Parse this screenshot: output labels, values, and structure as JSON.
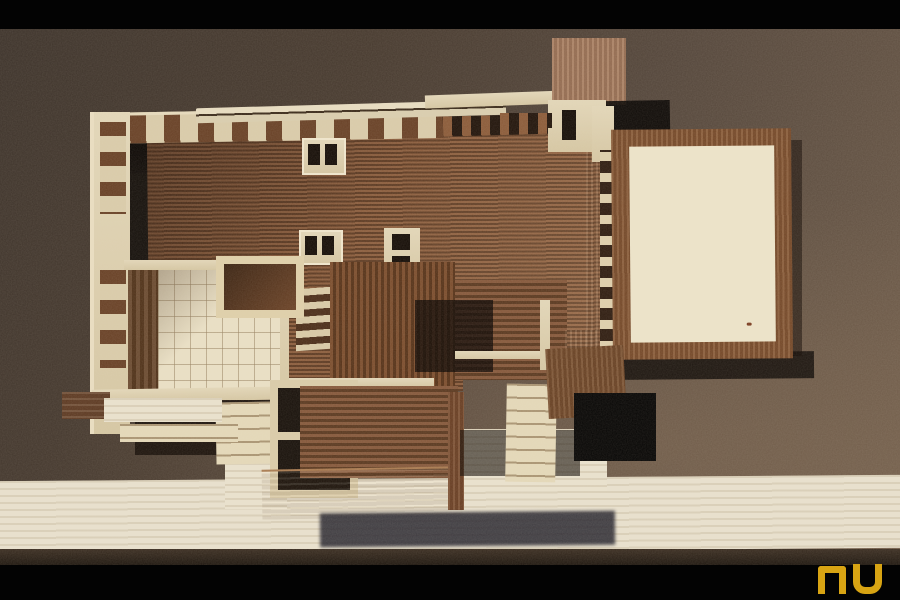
{
  "meta": {
    "domain": "Natural-Image",
    "description": "Overhead slide photograph of a wooden architectural scale model of a Prairie-style house on a dark speckled board, letterboxed by black bars, with a gold logo in the bottom-right corner."
  },
  "watermark": {
    "text": "nu",
    "color": "#d8a413"
  },
  "colors": {
    "letterbox": "#030303",
    "board_dark": "#3c322a",
    "board_mid": "#53453a",
    "board_light": "#6e5b49",
    "table_band": "#e8e0cd",
    "roof_base": "#7c4f33",
    "roof_rib": "#57351f",
    "wood_light": "#dacca9",
    "wood_cream": "#ece3c9",
    "frame_brown": "#7d4e2c",
    "shadow": "#0a0502",
    "wing_shadow": "#23222c",
    "gold": "#d8a413"
  },
  "scene": {
    "subject": "wooden architectural model, top view",
    "elements": [
      "long ribbed main roof",
      "light clerestory ridge strips",
      "two skylight boxes on roof",
      "central square chimney",
      "right walled courtyard with cream floor panel",
      "pergola slat band beside courtyard",
      "left gridded terrace with balsa walls",
      "lower wing roof with open pergola frame",
      "detached brown terrace block",
      "black cast shadow square",
      "cream table edge strip across bottom",
      "square deck block at top"
    ]
  }
}
